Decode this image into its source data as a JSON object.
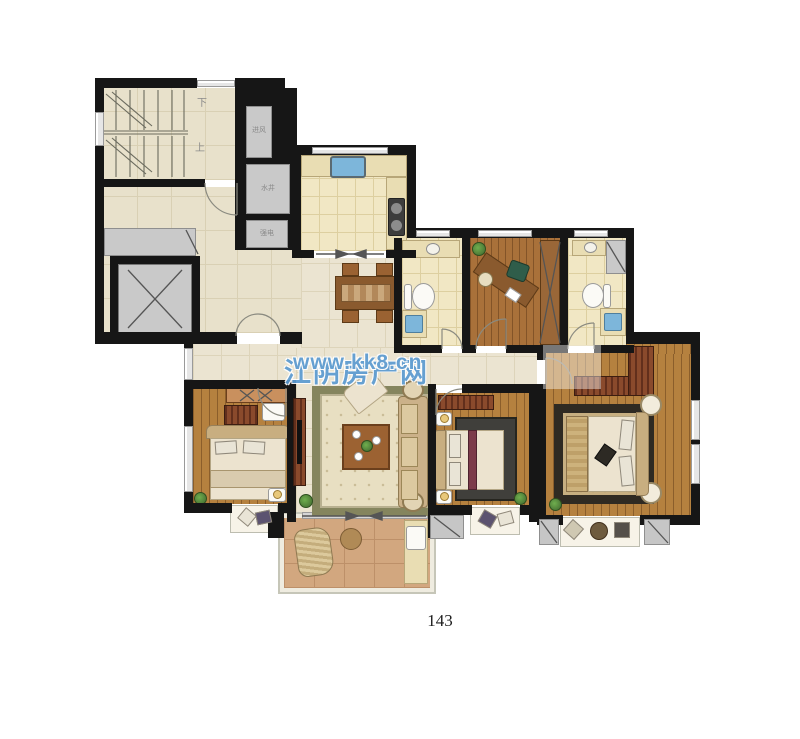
{
  "document": {
    "page_number": "143",
    "background": "#ffffff"
  },
  "watermark": {
    "site_name": "江阴房产网",
    "site_url": "www.kk8.cn"
  },
  "floor_plan": {
    "labels": {
      "stairs_down": "下",
      "stairs_up": "上",
      "shaft_air_intake": "进风",
      "shaft_water": "水井",
      "shaft_electric": "强电"
    },
    "colors": {
      "wall": "#161616",
      "beige": "#e8e1cb",
      "beige_line": "#d9d0b4",
      "marble": "#ebe4d1",
      "marble_line": "#ddd4ba",
      "tile": "#f1e7c4",
      "tile_line": "#ddcfa0",
      "wood": "#b5813f",
      "wood_study": "#a9713a",
      "balcony": "#d2a77f",
      "balcony_line": "#bd9069",
      "gray": "#c9c9c9",
      "hatch_a": "#622f1c",
      "hatch_b": "#8a4a2c",
      "counter": "#e9ddb3",
      "cream": "#ece3cf",
      "tan": "#c8ae80",
      "blue": "#7db6da",
      "green": "#4e7c38",
      "rug_border": "#85855e",
      "rug_field": "#e8dfc2",
      "rug2_border": "#2f2a22",
      "rug2_field": "#c7af81",
      "dark_rug": "#403f3b",
      "watermark": "#5b9bd2",
      "text_gray": "#8a8a8a"
    }
  }
}
